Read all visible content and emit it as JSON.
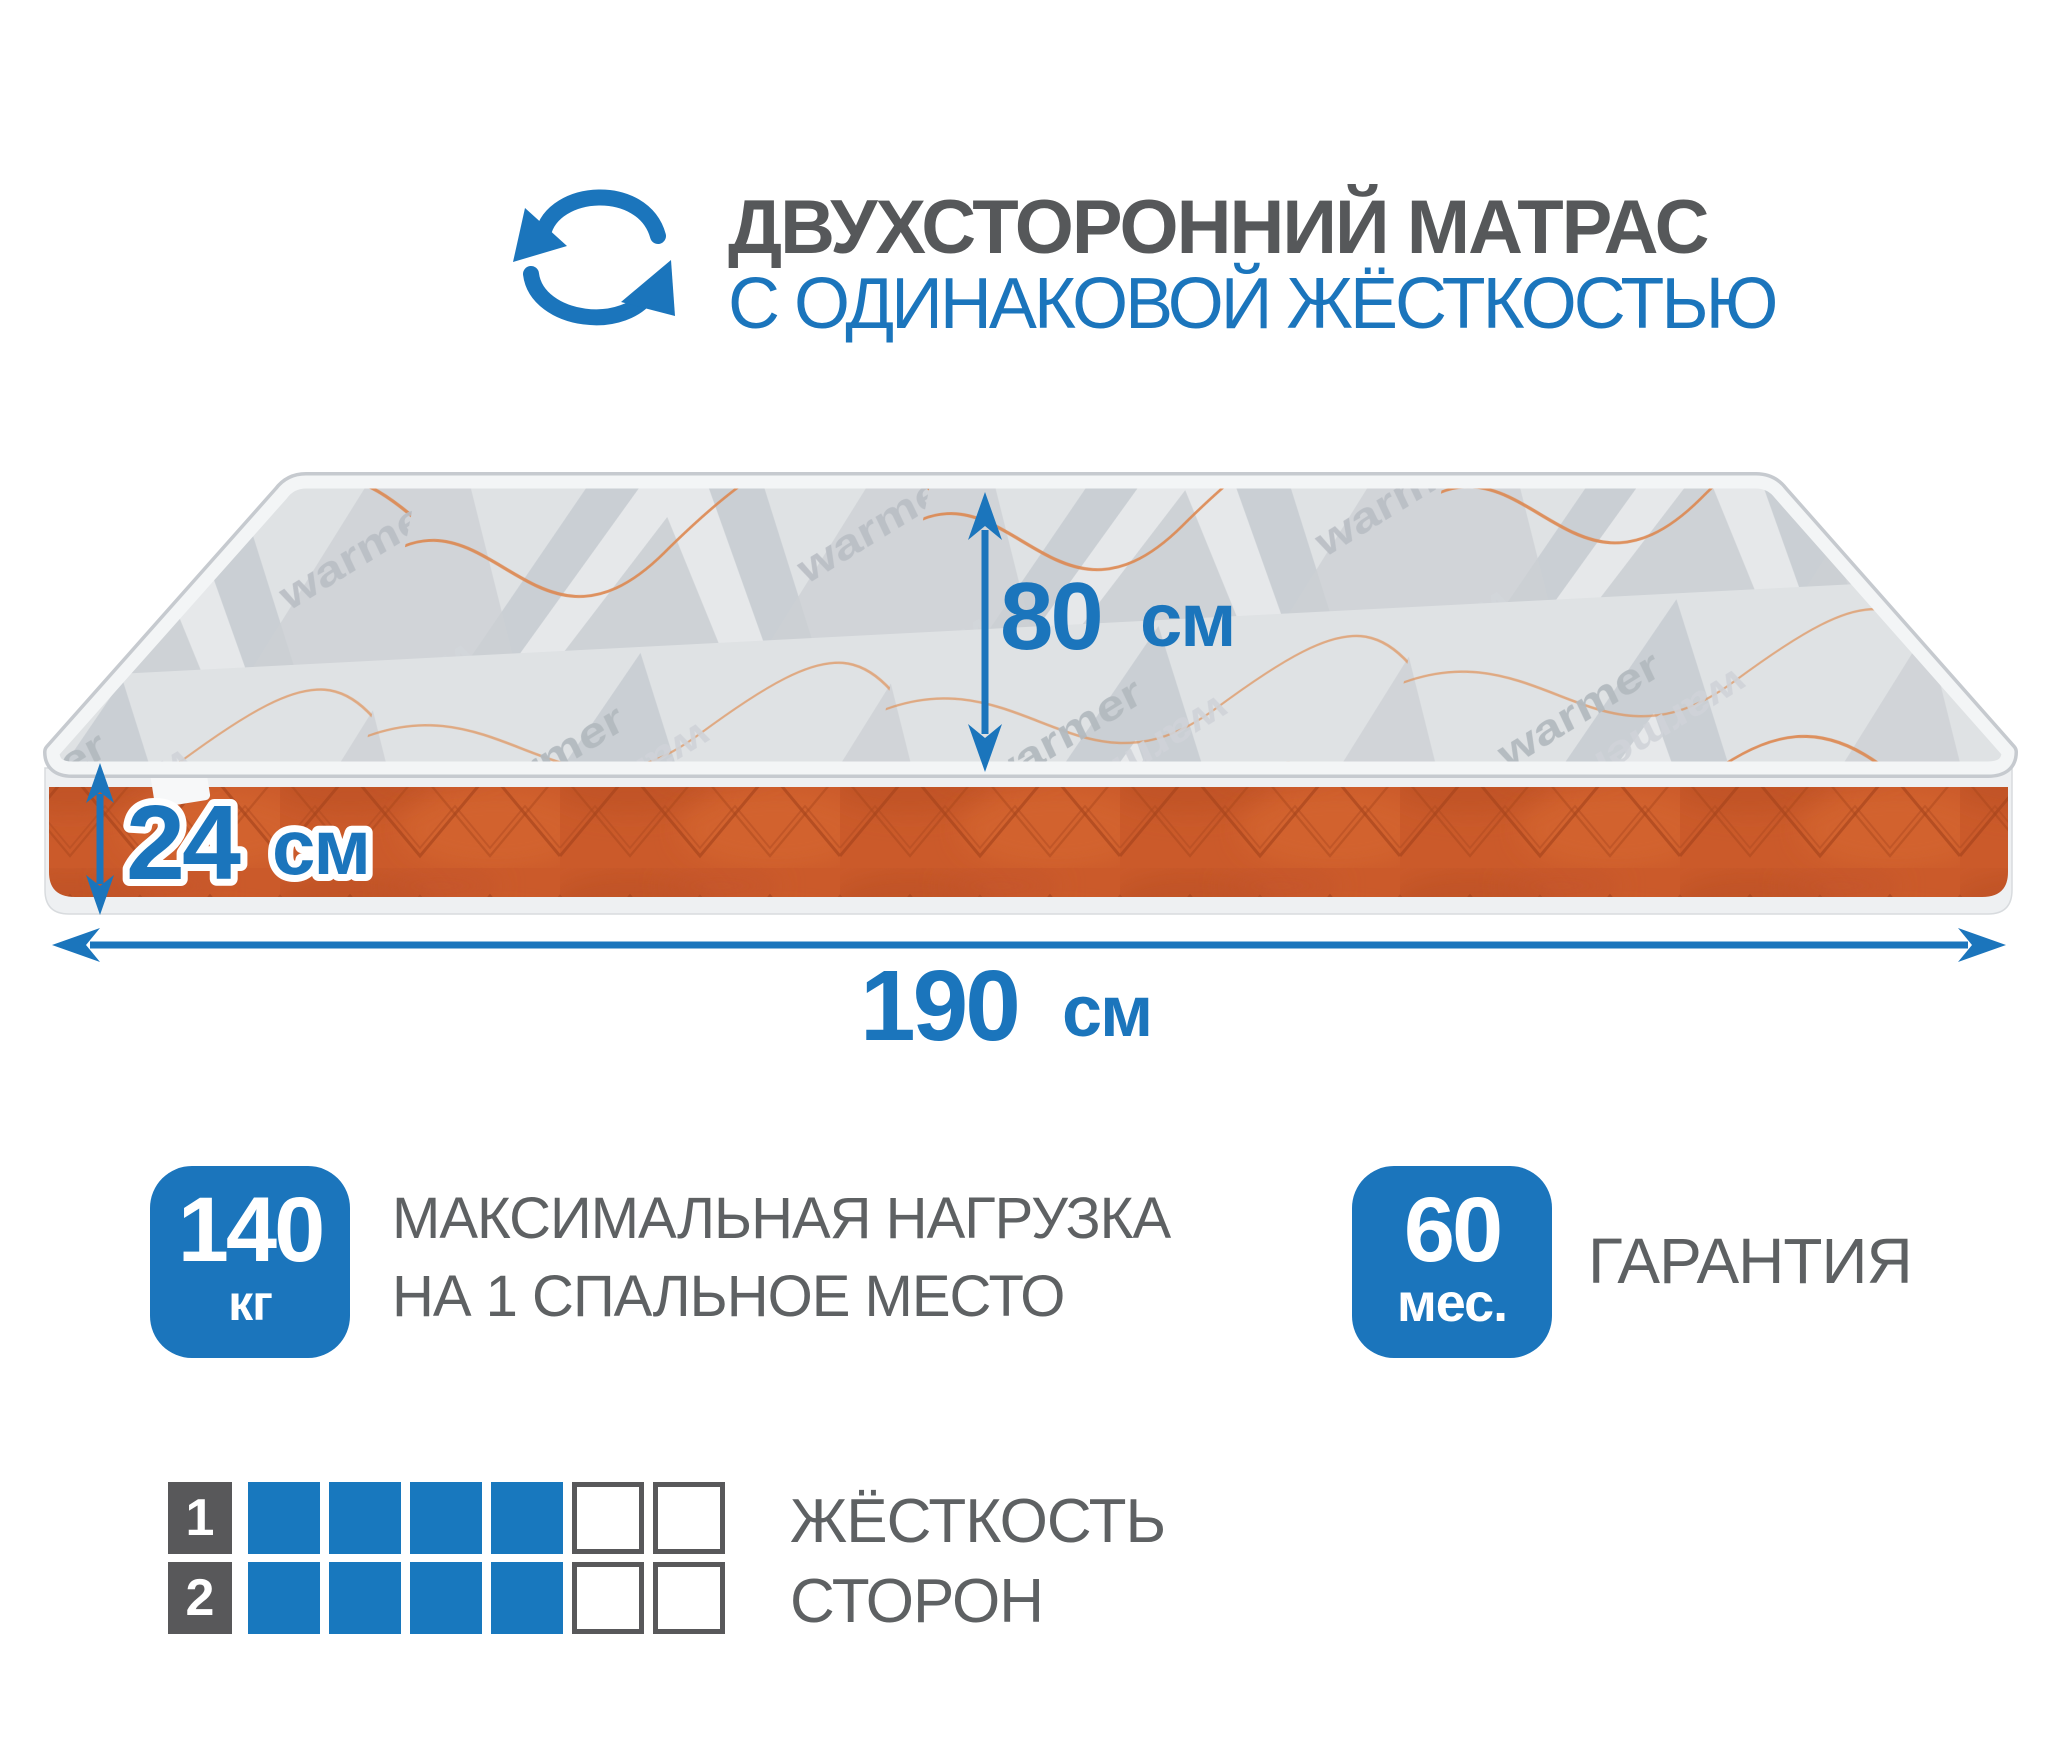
{
  "header": {
    "icon": "rotate-arrows-icon",
    "title_line1": "ДВУХСТОРОННИЙ МАТРАС",
    "title_line2": "С ОДИНАКОВОЙ ЖЁСТКОСТЬЮ"
  },
  "mattress": {
    "watermark": "warmer",
    "dimensions": {
      "width_cm": {
        "value": "80",
        "unit": "см"
      },
      "height_cm": {
        "value": "24",
        "unit": "см"
      },
      "length_cm": {
        "value": "190",
        "unit": "см"
      }
    }
  },
  "features": {
    "max_load": {
      "badge_value": "140",
      "badge_unit": "кг",
      "label_line1": "МАКСИМАЛЬНАЯ НАГРУЗКА",
      "label_line2": "НА 1 СПАЛЬНОЕ МЕСТО"
    },
    "warranty": {
      "badge_value": "60",
      "badge_unit": "мес.",
      "label": "ГАРАНТИЯ"
    }
  },
  "hardness_scale": {
    "label_line1": "ЖЁСТКОСТЬ",
    "label_line2": "СТОРОН",
    "max_cells": 6,
    "rows": [
      {
        "side": "1",
        "filled": 4
      },
      {
        "side": "2",
        "filled": 4
      }
    ]
  },
  "colors": {
    "accent_blue": "#1b75bc",
    "dark_gray": "#58585a",
    "text_gray": "#5e6163",
    "mattress_top_gray": "#dfe2e4",
    "mattress_side_orange": "#cb5a2a"
  }
}
